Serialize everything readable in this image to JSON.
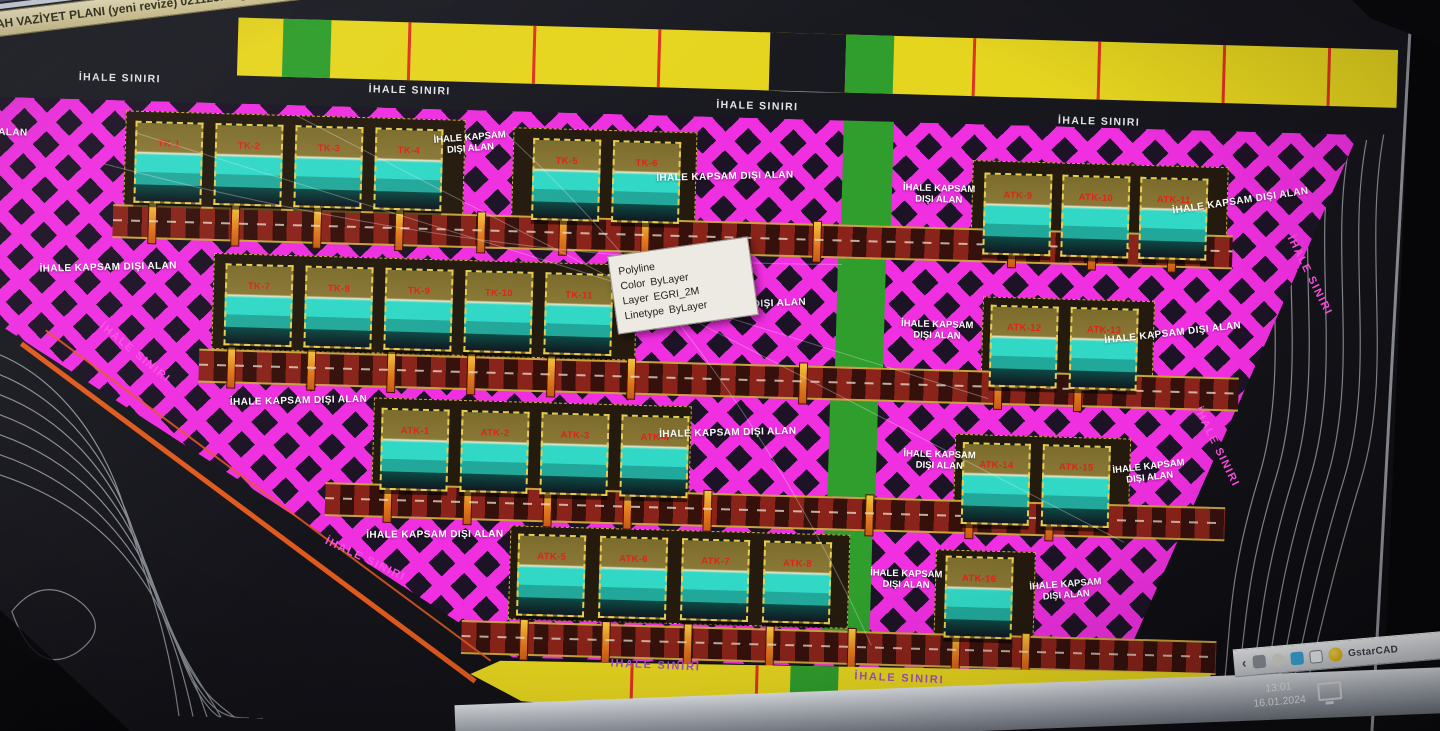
{
  "window": {
    "title": "AH VAZİYET PLANI (yeni revize) 021123.dwg"
  },
  "plan": {
    "boundary_label": "İHALE SINIRI",
    "excluded_label": "İHALE KAPSAM DIŞI ALAN",
    "excluded_line1": "İHALE KAPSAM",
    "excluded_line2": "DIŞI ALAN",
    "blocks": {
      "row1_left": [
        "TK-1",
        "TK-2",
        "TK-3",
        "TK-4"
      ],
      "row1_mid": [
        "TK-5",
        "TK-6"
      ],
      "row1_right": [
        "ATK-9",
        "ATK-10",
        "ATK-11"
      ],
      "row2_left": [
        "TK-7",
        "TK-8",
        "TK-9",
        "TK-10",
        "TK-11"
      ],
      "row2_right": [
        "ATK-12",
        "ATK-13"
      ],
      "row3_left": [
        "ATK-1",
        "ATK-2",
        "ATK-3",
        "ATK-4"
      ],
      "row3_right": [
        "ATK-14",
        "ATK-15"
      ],
      "row4_left": [
        "ATK-5",
        "ATK-6",
        "ATK-7",
        "ATK-8"
      ],
      "row4_right": [
        "ATK-16"
      ]
    }
  },
  "tooltip": {
    "entity": "Polyline",
    "color_label": "Color",
    "color_value": "ByLayer",
    "layer_label": "Layer",
    "layer_value": "EGRI_2M",
    "linetype_label": "Linetype",
    "linetype_value": "ByLayer"
  },
  "taskbar": {
    "tray_expand": "‹",
    "app_name": "GstarCAD",
    "time": "13:01",
    "date": "16.01.2024"
  },
  "colors": {
    "hatch_magenta": "#ef2fe0",
    "parcel_yellow": "#e6d51f",
    "strip_green": "#2f9e2c",
    "block_cyan": "#31d8c6",
    "road_red": "#8a241a",
    "label_red": "#e0241c",
    "boundary_text": "#ff4fe6"
  }
}
